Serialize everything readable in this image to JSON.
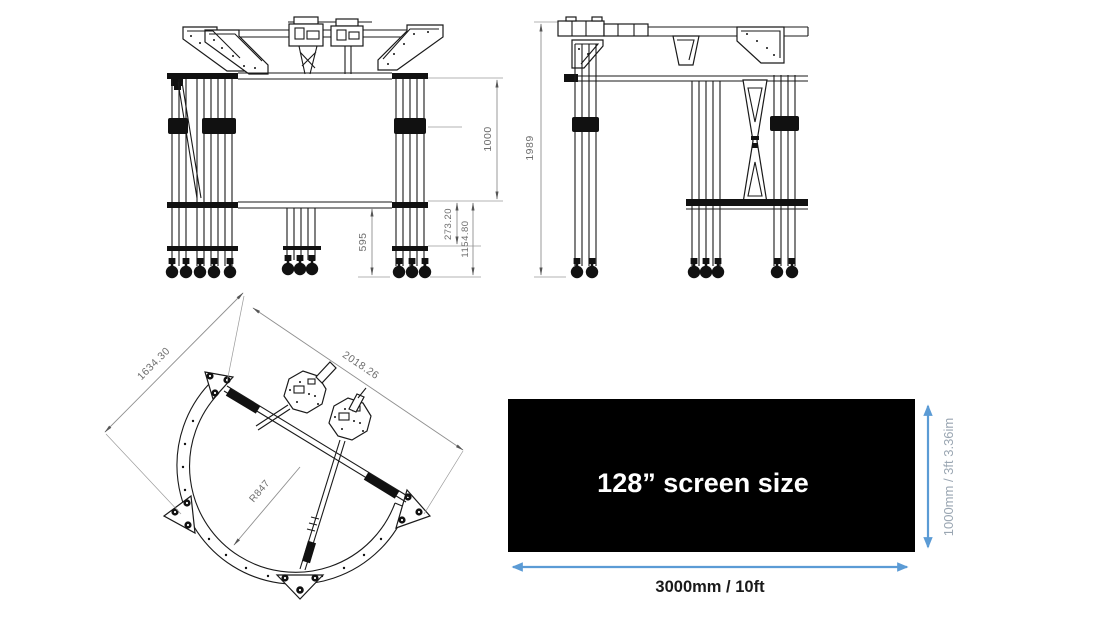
{
  "page": {
    "background": "#ffffff"
  },
  "front_view": {
    "dims": {
      "height_upper": "1000",
      "offset_small": "273.20",
      "offset_large": "1154.80",
      "leg_height": "595"
    }
  },
  "side_view": {
    "dims": {
      "total_height": "1989"
    }
  },
  "top_view": {
    "dims": {
      "width_left": "1634.30",
      "width_right": "2018.26",
      "radius": "R847"
    }
  },
  "screen": {
    "label": "128” screen size",
    "width_label": "3000mm / 10ft",
    "height_label": "1000mm / 3ft 3.36im",
    "colors": {
      "screen_bg": "#000000",
      "screen_text": "#ffffff",
      "arrow": "#5B9BD5",
      "height_label_text": "#9aa6b2",
      "width_label_text": "#1a1a1a"
    }
  }
}
